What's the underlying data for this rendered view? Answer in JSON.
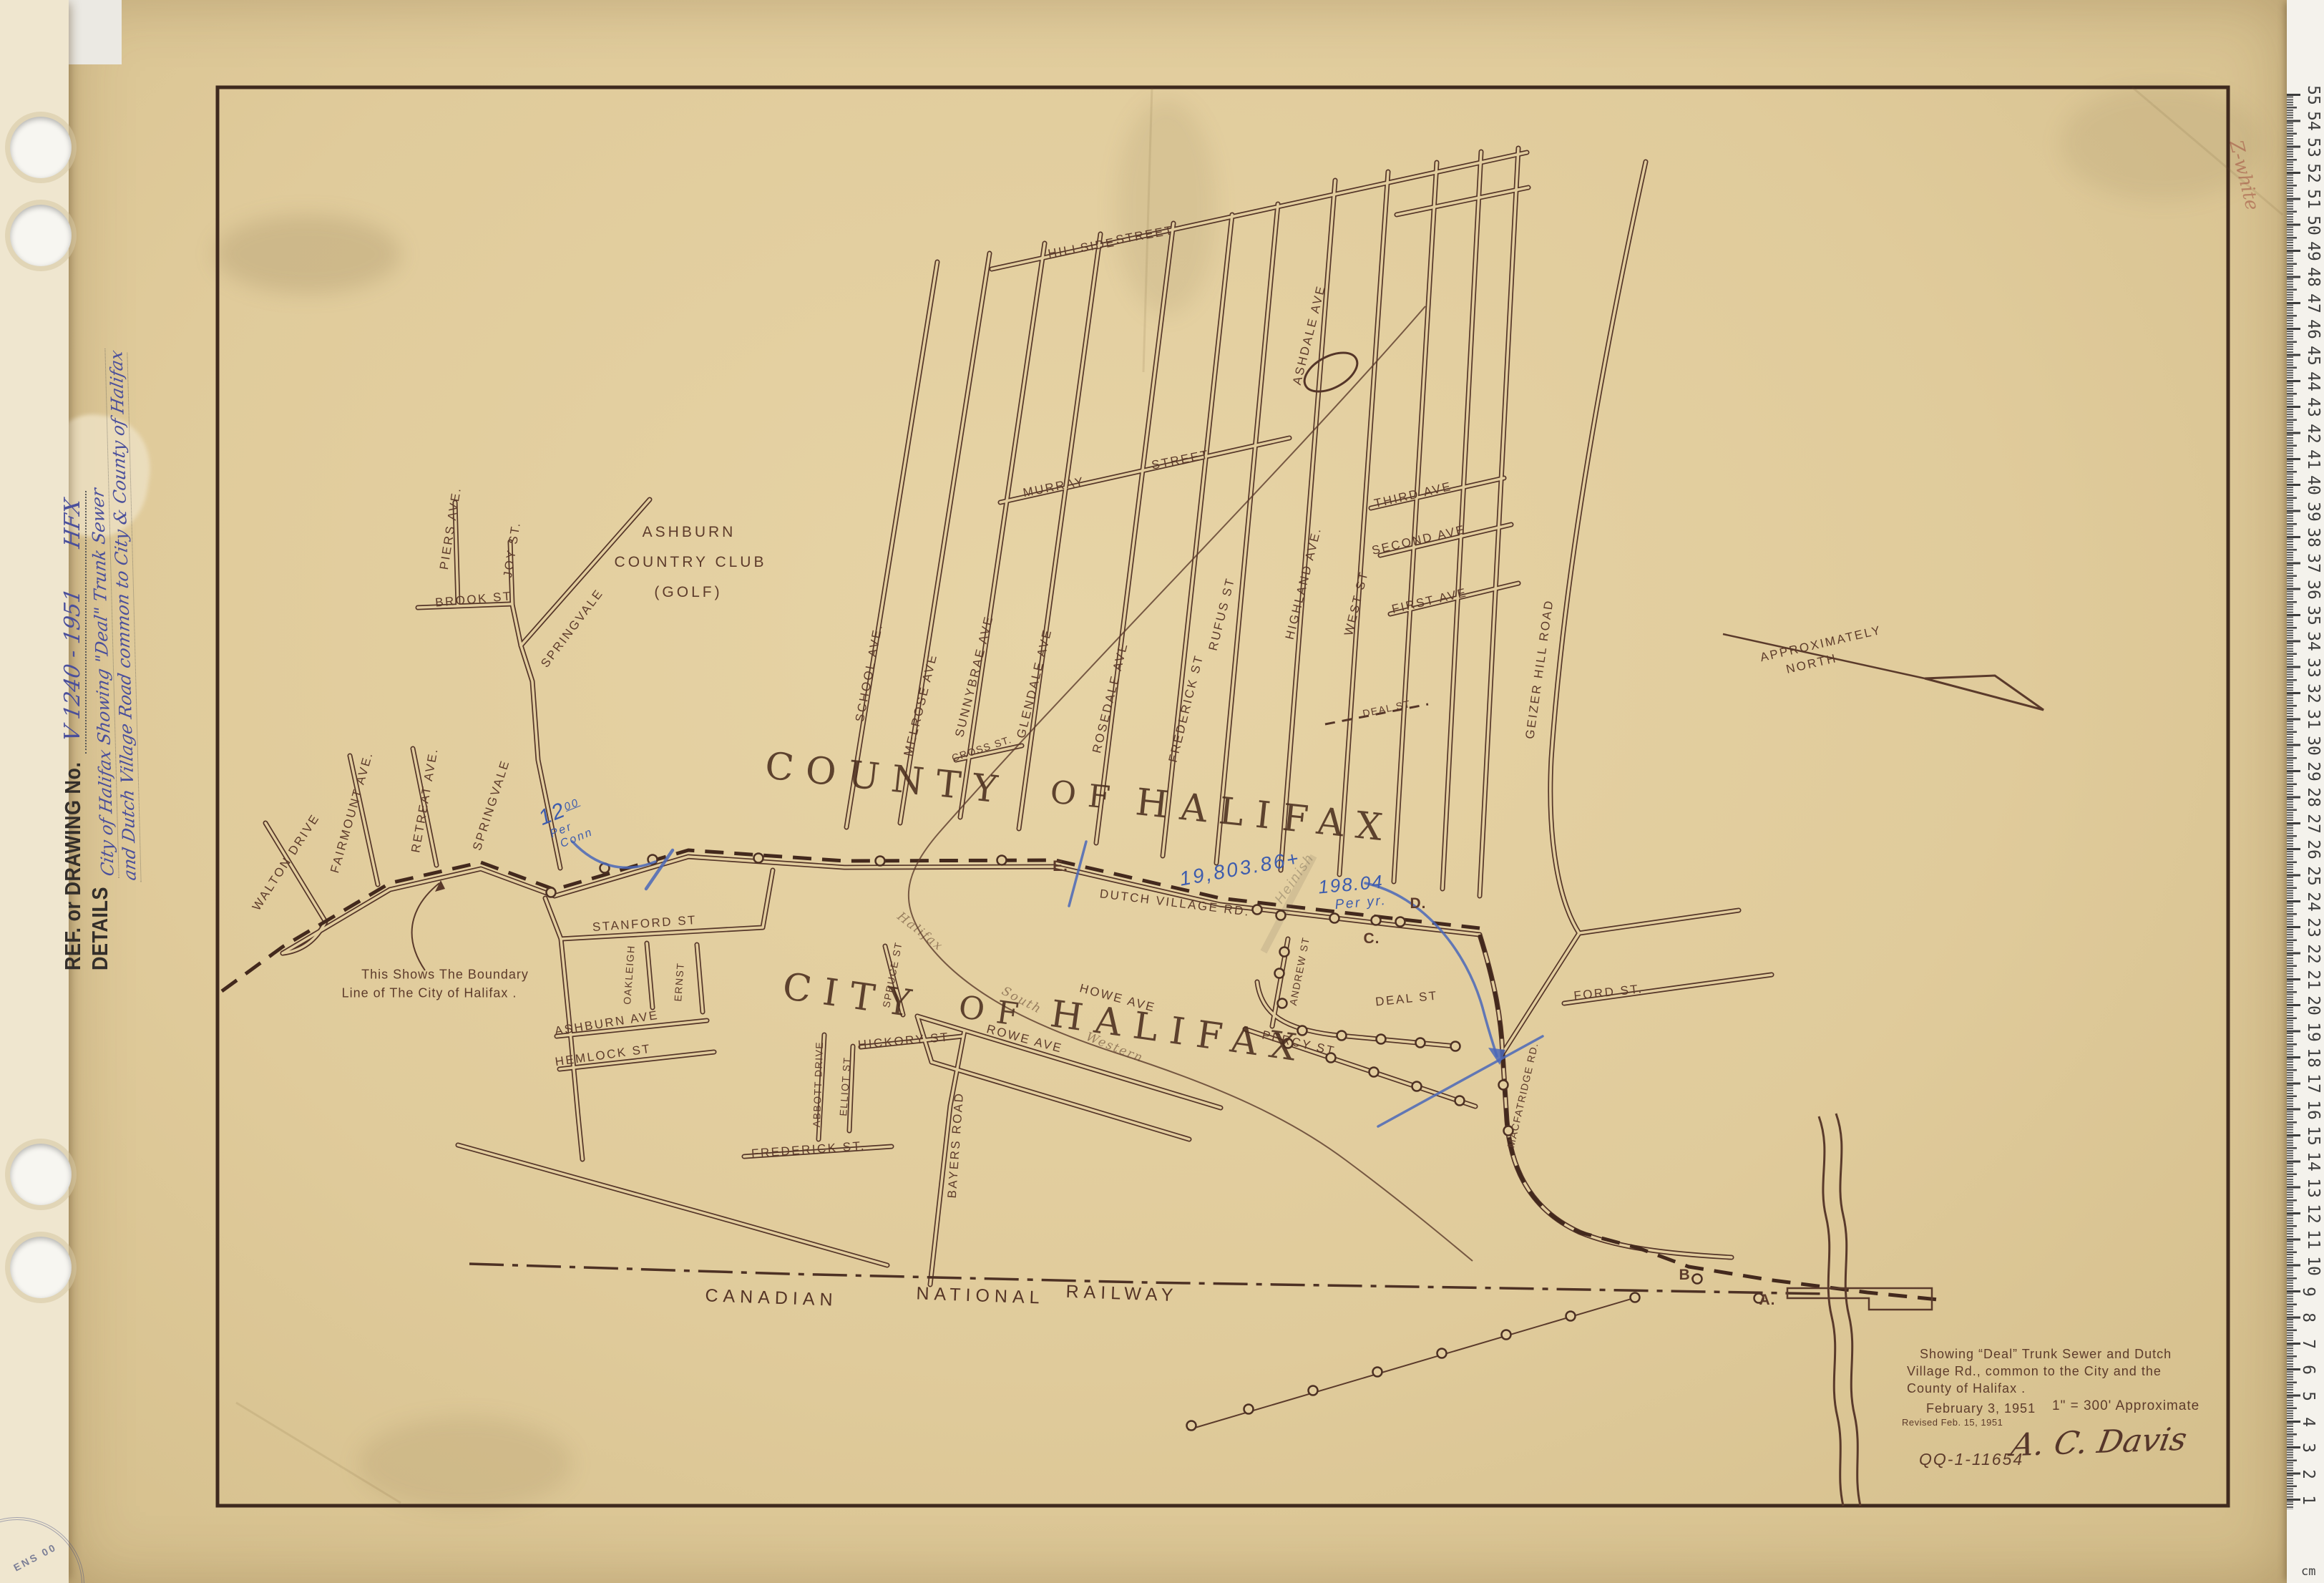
{
  "side_strip": {
    "ref_label": "REF. or DRAWING No.",
    "ref_value": "V 1240 - 1951      HFX",
    "details_label": "DETAILS",
    "details_line1": "City of Halifax Showing \"Deal\" Trunk Sewer",
    "details_line2": "and Dutch Village Road common to City & County of Halifax",
    "stamp_text": "ENS 00"
  },
  "ruler": {
    "unit": "cm",
    "annotation": "Z-white",
    "numbers": [
      55,
      54,
      53,
      52,
      51,
      50,
      49,
      48,
      47,
      46,
      45,
      44,
      43,
      42,
      41,
      40,
      39,
      38,
      37,
      36,
      35,
      34,
      33,
      32,
      31,
      30,
      29,
      28,
      27,
      26,
      25,
      24,
      23,
      22,
      21,
      20,
      19,
      18,
      17,
      16,
      15,
      14,
      13,
      12,
      11,
      10,
      9,
      8,
      7,
      6,
      5,
      4,
      3,
      2,
      1
    ]
  },
  "map": {
    "county_words": [
      "COUNTY",
      "OF",
      "HALIFAX"
    ],
    "city_words": [
      "CITY",
      "OF",
      "HALIFAX"
    ],
    "golf": [
      "ASHBURN",
      "COUNTRY CLUB",
      "(GOLF)"
    ],
    "north": [
      "APPROXIMATELY",
      "NORTH"
    ],
    "railway": [
      "CANADIAN",
      "NATIONAL",
      "RAILWAY"
    ],
    "hsw": [
      "Halifax",
      "South",
      "Western"
    ],
    "points": {
      "a": "A.",
      "b": "B.",
      "c": "C.",
      "d": "D.",
      "e": "E."
    },
    "notes": {
      "boundary1": "This Shows The Boundary",
      "boundary2": "Line of The City of Halifax ."
    },
    "street_labels": [
      "HILLSIDE",
      "STREET",
      "MURRAY",
      "STREET",
      "SCHOOL AVE.",
      "MELROSE AVE",
      "CROSS ST.",
      "SUNNYBRAE AVE",
      "GLENDALE AVE",
      "ROSEDALE AVE",
      "FREDERICK ST",
      "RUFUS ST",
      "HIGHLAND AVE.",
      "WEST ST",
      "THIRD AVE",
      "SECOND AVE",
      "FIRST AVE",
      "DEAL ST",
      "ASHDALE AVE",
      "GEIZER HILL ROAD",
      "PIERS AVE.",
      "JOY ST.",
      "BROOK ST",
      "SPRINGVALE",
      "SPRINGVALE",
      "WALTON DRIVE",
      "FAIRMOUNT AVE.",
      "RETREAT AVE.",
      "DUTCH VILLAGE RD.",
      "STANFORD ST",
      "OAKLEIGH",
      "ERNST",
      "ASHBURN AVE",
      "HEMLOCK ST",
      "ABBOTT DRIVE",
      "ELLIOT ST",
      "HICKORY ST",
      "SPRUCE ST",
      "ROWE AVE",
      "HOWE AVE",
      "FREDERICK ST.",
      "BAYERS ROAD",
      "ANDREW ST",
      "DEAL ST",
      "PERCY ST",
      "FORD ST.",
      "MACFATRIDGE RD."
    ],
    "blue": {
      "per_conn_amount": "12",
      "per_conn_sup": "00",
      "per_conn_1": "Per",
      "per_conn_2": "Conn",
      "total": "19,803.86+",
      "per_year_amount": "198.04",
      "per_year": "Per yr."
    },
    "pencil_note": "Heinish"
  },
  "title_block": {
    "line1": "Showing “Deal” Trunk Sewer and Dutch",
    "line2": "Village Rd., common to the City and the",
    "line3": "County of Halifax .",
    "date": "February 3, 1951",
    "revised": "Revised Feb. 15, 1951",
    "scale": "1\" = 300' Approximate",
    "signature": "A. C. Davis",
    "file_no": "QQ-1-11654"
  }
}
